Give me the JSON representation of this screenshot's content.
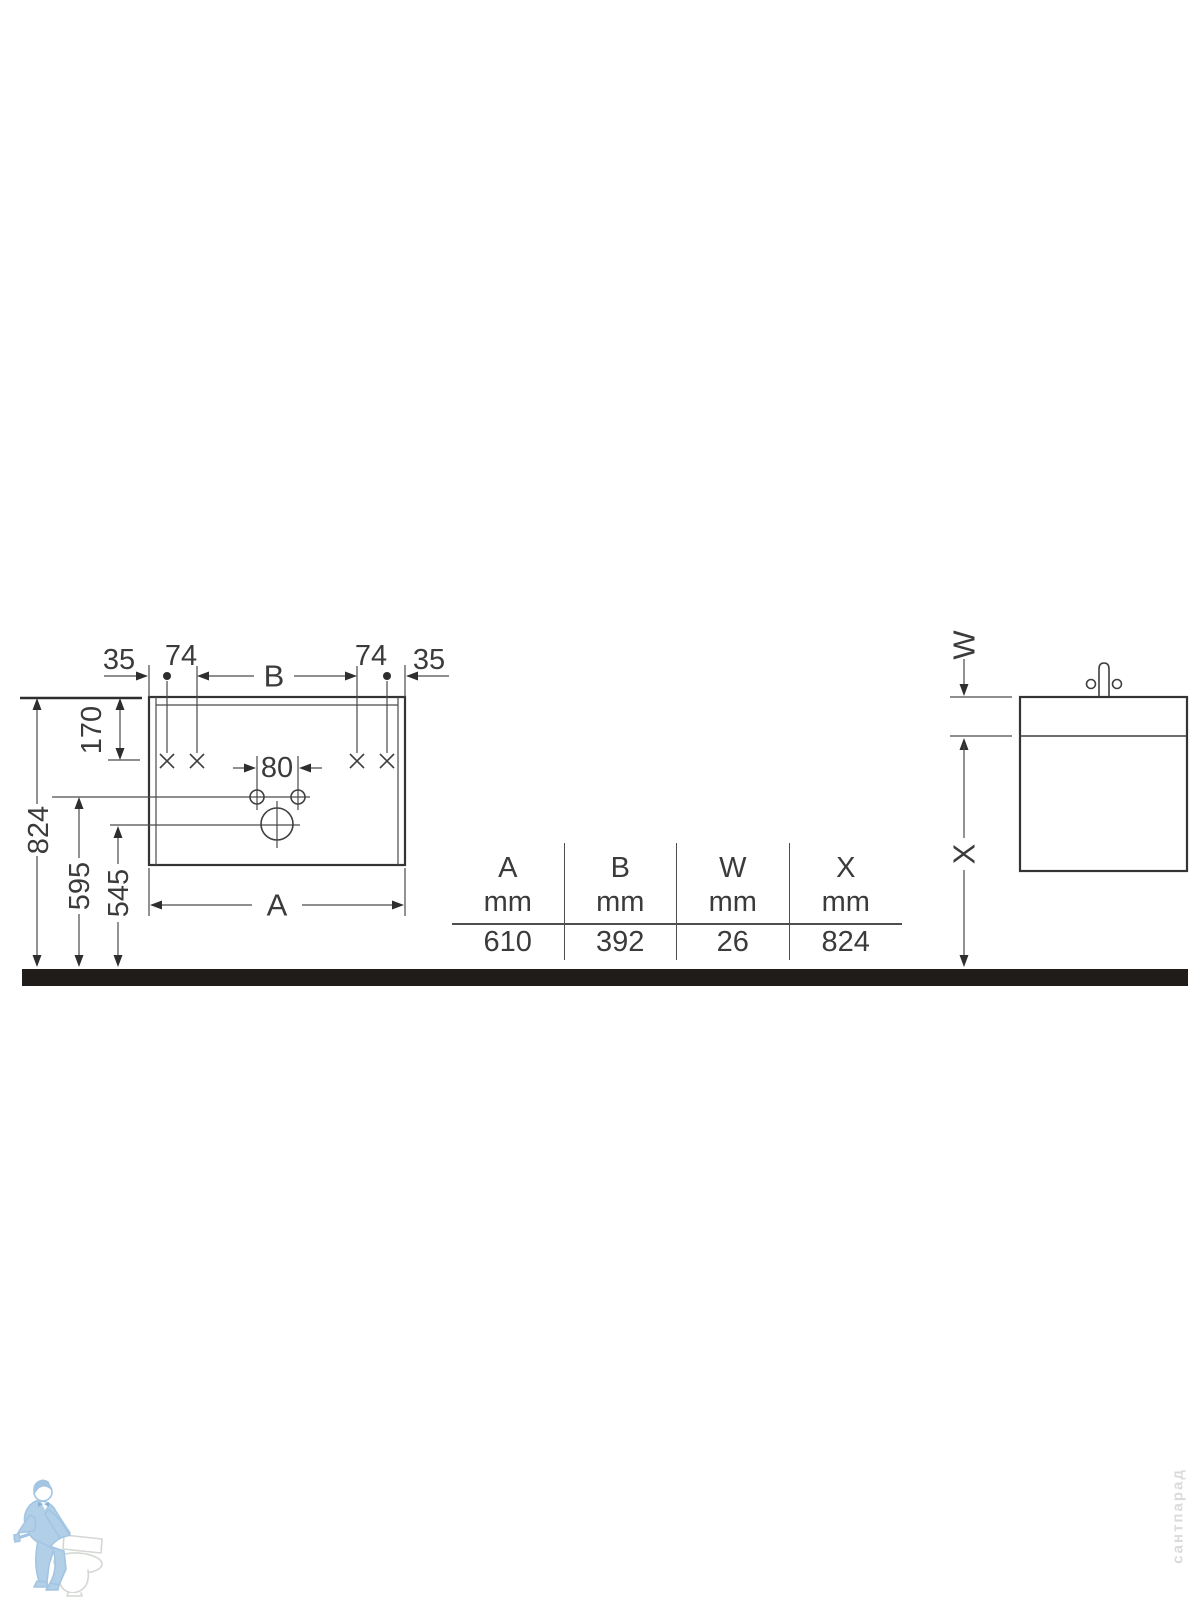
{
  "drawing": {
    "front_view": {
      "labels": {
        "offset_left": "35",
        "pitch_left": "74",
        "width_between_fixings": "B",
        "pitch_right": "74",
        "offset_right": "35",
        "top_to_fixing": "170",
        "height_total": "824",
        "height_faucet_holes": "595",
        "height_drain": "545",
        "faucet_hole_pitch": "80",
        "width_total": "A"
      }
    },
    "side_view": {
      "labels": {
        "counter_thickness": "W",
        "underside_height": "X"
      }
    }
  },
  "table": {
    "columns": [
      {
        "letter": "A",
        "unit": "mm",
        "value": "610"
      },
      {
        "letter": "B",
        "unit": "mm",
        "value": "392"
      },
      {
        "letter": "W",
        "unit": "mm",
        "value": "26"
      },
      {
        "letter": "X",
        "unit": "mm",
        "value": "824"
      }
    ]
  },
  "watermark": {
    "shop_text": "сантпарад"
  },
  "colors": {
    "line": "#3f3f3f",
    "text": "#3b3b3b",
    "ground_bar": "#1f1c19",
    "table_rule": "#4f4f4f",
    "logo_blue": "#b2cfe8",
    "watermark_text": "#dbdbdb"
  }
}
